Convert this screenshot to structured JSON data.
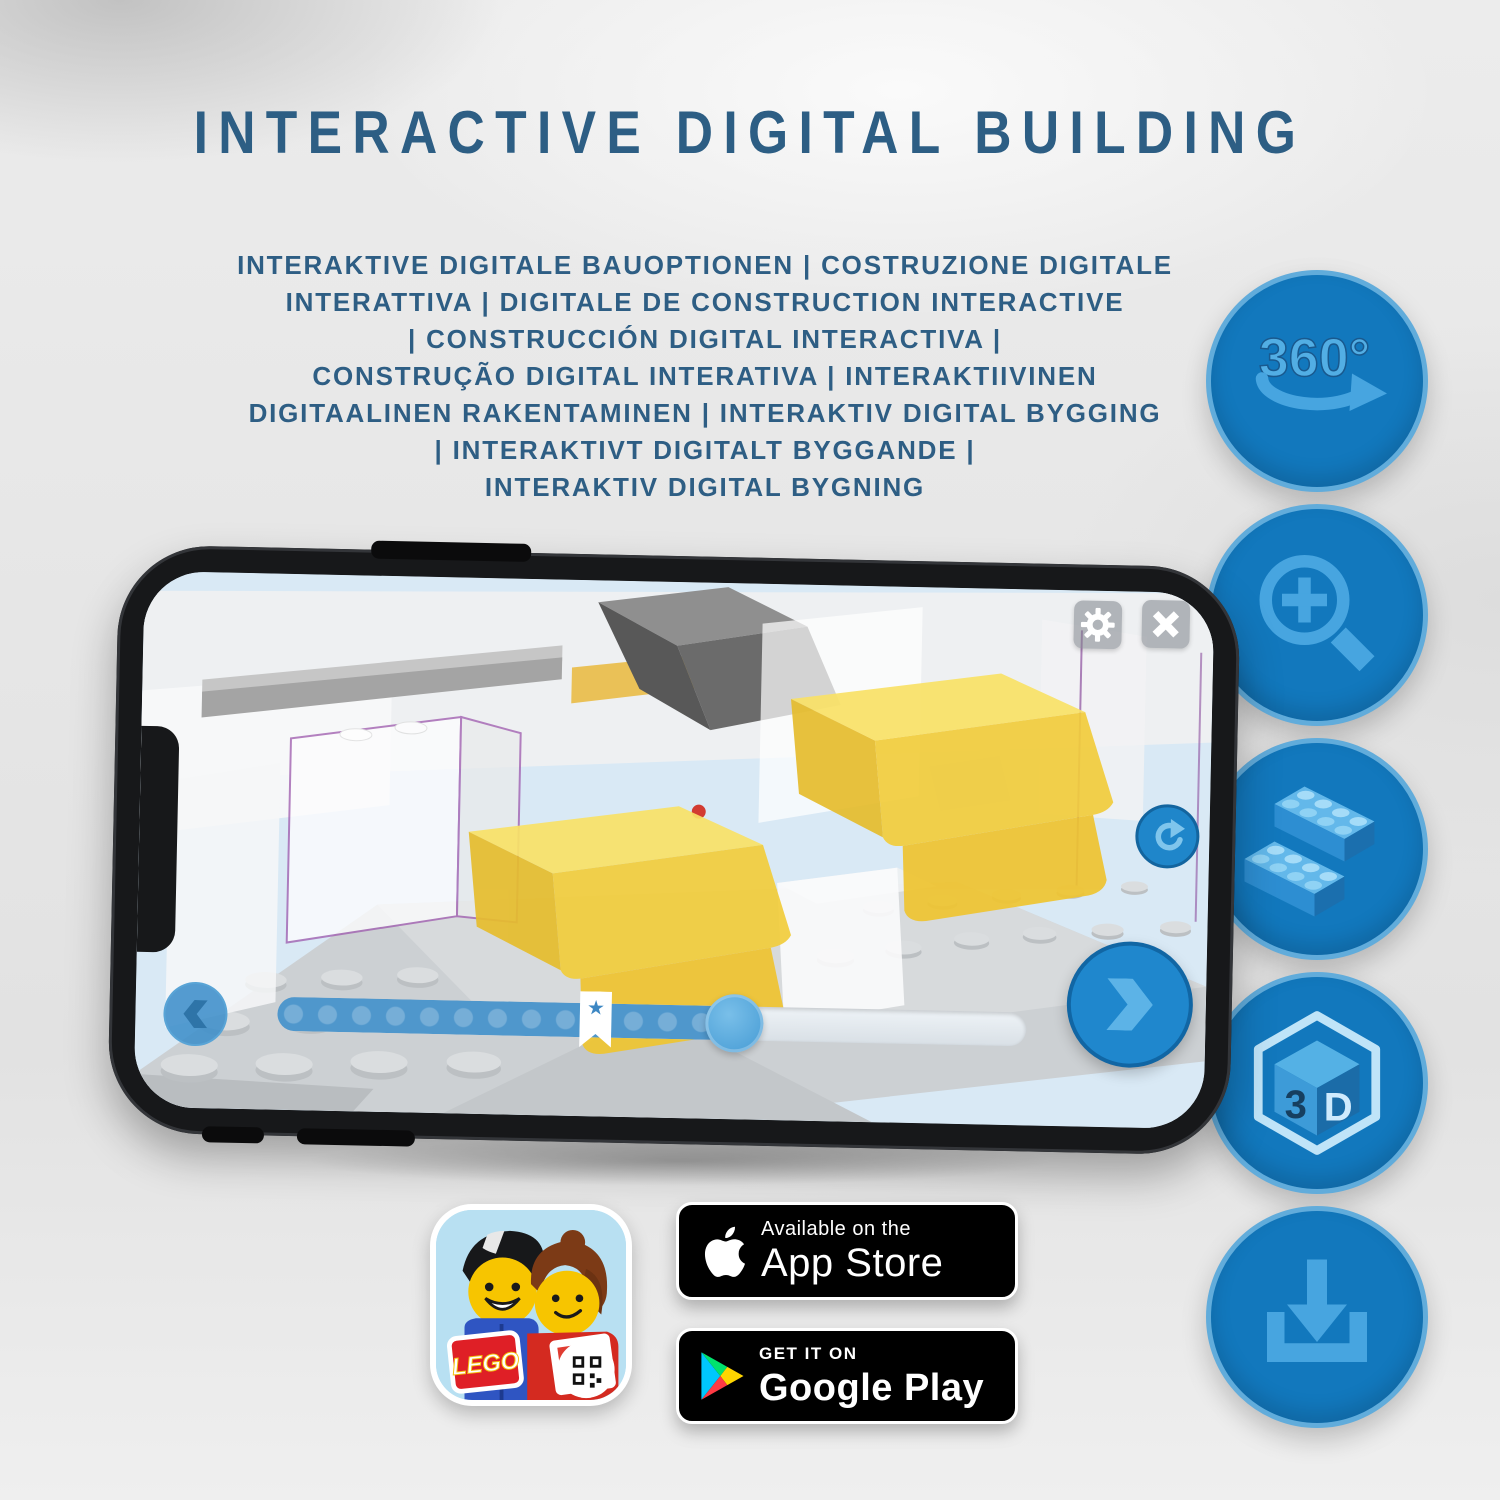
{
  "header": {
    "title": "INTERACTIVE DIGITAL BUILDING",
    "subtitle_lines": [
      "INTERAKTIVE DIGITALE BAUOPTIONEN | COSTRUZIONE DIGITALE",
      "INTERATTIVA | DIGITALE DE CONSTRUCTION INTERACTIVE",
      "| CONSTRUCCIÓN DIGITAL INTERACTIVA |",
      "CONSTRUÇÃO DIGITAL INTERATIVA | INTERAKTIIVINEN",
      "DIGITAALINEN RAKENTAMINEN | INTERAKTIV DIGITAL BYGGING",
      "| INTERAKTIVT DIGITALT BYGGANDE |",
      "INTERAKTIV DIGITAL BYGNING"
    ]
  },
  "feature_icons": [
    {
      "name": "360-rotation-icon",
      "label": "360°"
    },
    {
      "name": "zoom-in-icon"
    },
    {
      "name": "lego-bricks-icon"
    },
    {
      "name": "3d-view-icon",
      "cube_left": "3",
      "cube_right": "D"
    },
    {
      "name": "download-icon"
    }
  ],
  "phone_app": {
    "buttons": [
      "settings",
      "close",
      "rotate",
      "previous",
      "next"
    ],
    "slider": {
      "progress_percent": 61,
      "bookmark_percent": 42.5,
      "star_glyph": "★"
    }
  },
  "badges": {
    "lego_icon_logo": "LEGO",
    "app_store": {
      "line1": "Available on the",
      "line2": "App Store"
    },
    "google_play": {
      "line1": "GET IT ON",
      "line2": "Google Play"
    }
  },
  "colors": {
    "title_blue": "#2d5e84",
    "feature_circle_blue": "#1278bd",
    "feature_icon_light_blue": "#47a5e0",
    "app_accent_blue": "#1f87cd",
    "badge_black": "#000000",
    "lego_yellow": "#f2cd3c"
  }
}
